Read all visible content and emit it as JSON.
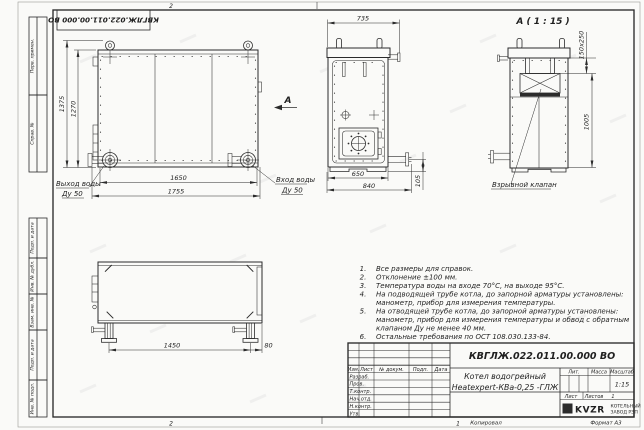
{
  "colors": {
    "paper": "#fafaf8",
    "ink": "#2b2b2b"
  },
  "frame": {
    "doc_number_inverted": "КВГЛЖ.022.011.00.000 ВО",
    "fold_mark_top": "2",
    "fold_mark_bottom": "2",
    "fold_mark_bottom_2": "1",
    "columns": [
      "Перв. примен.",
      "Справ. №",
      "Подп. и дата",
      "Инв. № дубл.",
      "Взам. инв. №",
      "Подп. и дата",
      "Инв. № подл."
    ]
  },
  "views": {
    "front": {
      "dim_height_outer": "1375",
      "dim_height_inner": "1270",
      "dim_width_inner": "1650",
      "dim_width_outer": "1755",
      "outlet_label": "Выход воды",
      "outlet_dn": "Ду 50",
      "inlet_label": "Вход воды",
      "inlet_dn": "Ду 50",
      "view_arrow": "А"
    },
    "side": {
      "dim_top": "735",
      "dim_bottom_inner": "650",
      "dim_bottom_outer": "840",
      "dim_pipe": "105"
    },
    "detail": {
      "title": "А ( 1 : 15 )",
      "dim_section": "150x250",
      "dim_height": "1005",
      "valve_label": "Взрывной клапан"
    },
    "bottom": {
      "dim_width": "1450",
      "dim_offset": "80"
    }
  },
  "notes": {
    "lines": [
      {
        "num": "1.",
        "text": "Все размеры для справок."
      },
      {
        "num": "2.",
        "text": "Отклонение ±100 мм."
      },
      {
        "num": "3.",
        "text": "Температура воды на входе 70°С, на выходе 95°С."
      },
      {
        "num": "4.",
        "text": "На подводящей трубе котла, до запорной арматуры установлены:"
      },
      {
        "num": "",
        "text": "манометр, прибор для измерения температуры."
      },
      {
        "num": "5.",
        "text": "На отводящей трубе котла, до запорной арматуры установлены:"
      },
      {
        "num": "",
        "text": "манометр, прибор для измерения температуры и обвод с обратным"
      },
      {
        "num": "",
        "text": "клапаном Ду не менее 40 мм."
      },
      {
        "num": "6.",
        "text": "Остальные требования по ОСТ 108.030.133-84."
      }
    ]
  },
  "title_block": {
    "doc_number": "КВГЛЖ.022.011.00.000 ВО",
    "name_line1": "Котел водогрейный",
    "name_line2": "Heatexpert-КВа-0,25 -ГЛЖ",
    "cols": {
      "izm": "Изм.",
      "list": "Лист",
      "doc": "№ докум.",
      "podp": "Подп.",
      "data": "Дата"
    },
    "rows": [
      "Разраб.",
      "Пров.",
      "Т.контр.",
      "Нач.отд.",
      "Н.контр.",
      "Утв."
    ],
    "lit_label": "Лит.",
    "mass_label": "Масса",
    "scale_label": "Масштаб",
    "scale_value": "1:15",
    "sheet_label": "Лист",
    "sheets_label": "Листов",
    "sheets_value": "1",
    "logo_text": "KVZR",
    "company_line1": "КОТЕЛЬНЫЙ",
    "company_line2": "ЗАВОД РЭП",
    "footer_copy": "Копировал",
    "footer_format": "Формат А3"
  }
}
